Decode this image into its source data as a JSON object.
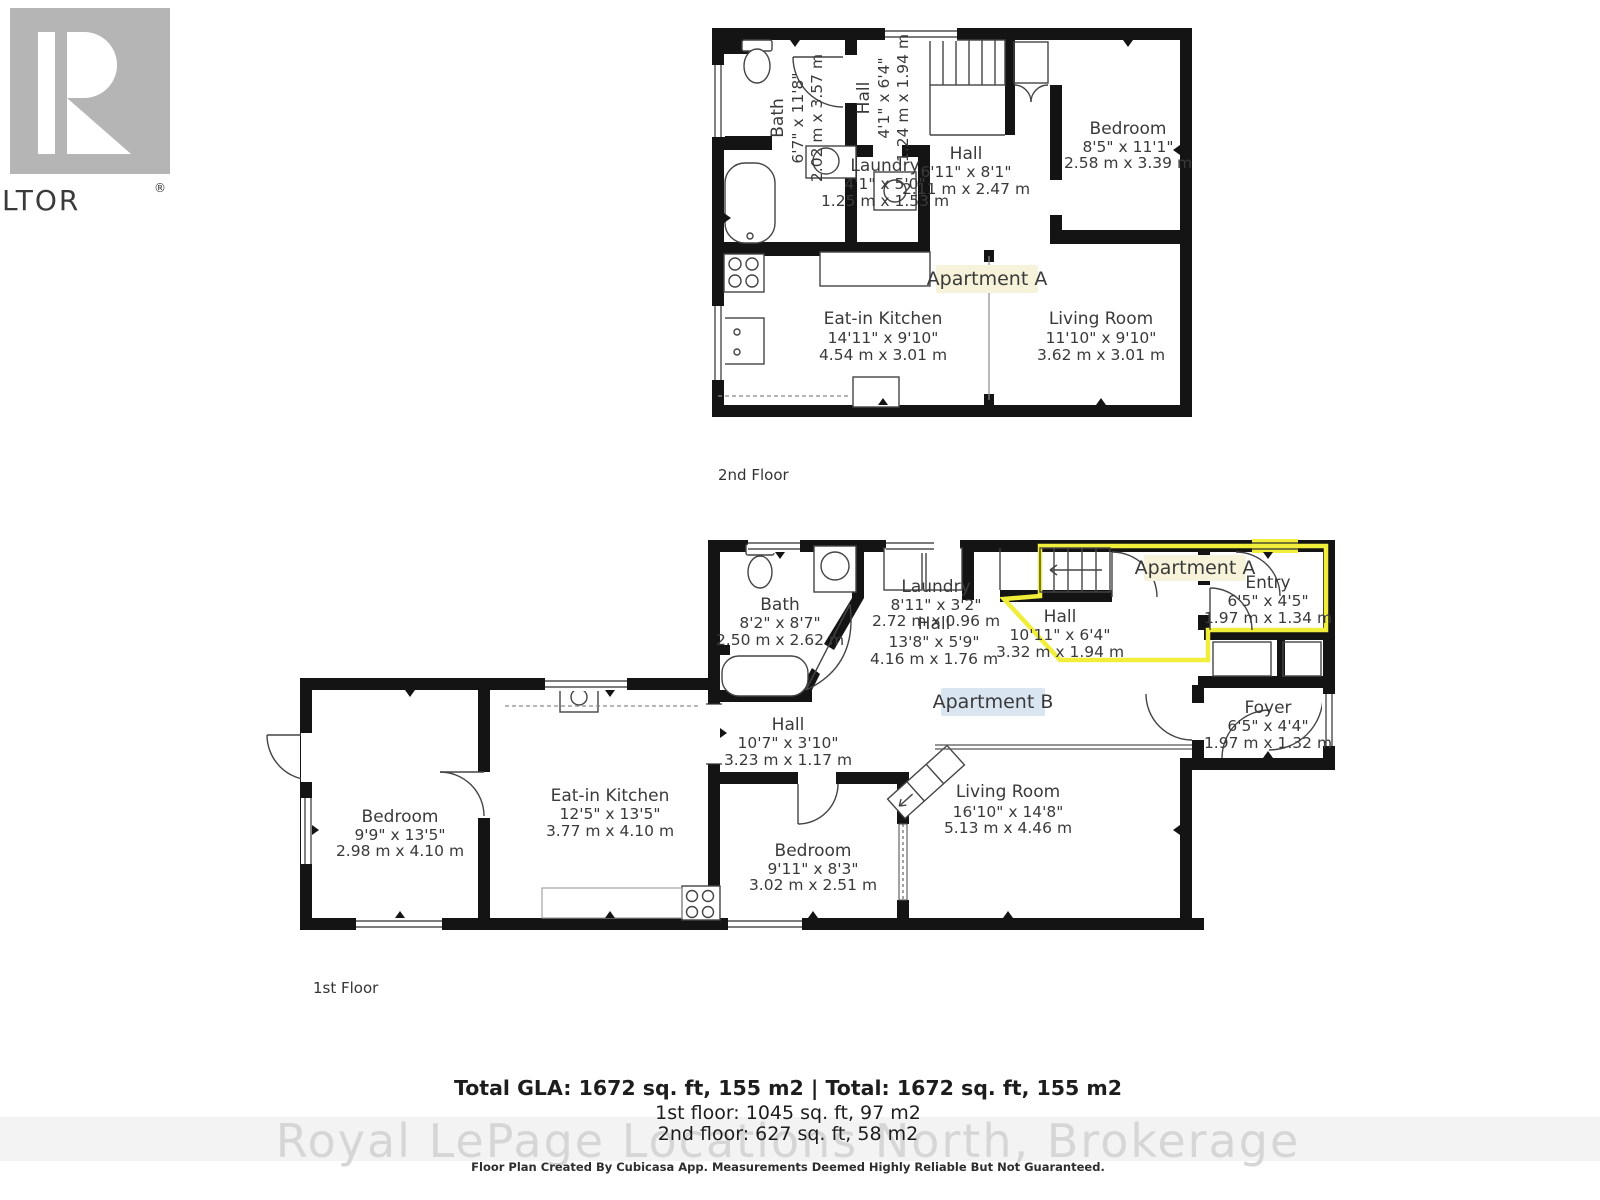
{
  "logo": {
    "letter": "R",
    "label": "REALTOR",
    "registered": "®"
  },
  "floor2": {
    "floor_label": "2nd Floor",
    "apartment_label": "Apartment A",
    "rooms": {
      "bath": {
        "name": "Bath",
        "ft": "6'7\" x 11'8\"",
        "m": "2.02 m x 3.57 m"
      },
      "hall_upper": {
        "name": "Hall",
        "ft": "4'1\" x 6'4\"",
        "m": "1.24 m x 1.94 m"
      },
      "laundry": {
        "name": "Laundry",
        "ft": "4'1\" x 5'0\"",
        "m": "1.25 m x 1.53 m"
      },
      "hall": {
        "name": "Hall",
        "ft": "6'11\" x 8'1\"",
        "m": "2.11 m x 2.47 m"
      },
      "bedroom": {
        "name": "Bedroom",
        "ft": "8'5\" x 11'1\"",
        "m": "2.58 m x 3.39 m"
      },
      "kitchen": {
        "name": "Eat-in Kitchen",
        "ft": "14'11\" x 9'10\"",
        "m": "4.54 m x 3.01 m"
      },
      "living": {
        "name": "Living Room",
        "ft": "11'10\" x 9'10\"",
        "m": "3.62 m x 3.01 m"
      }
    }
  },
  "floor1": {
    "floor_label": "1st Floor",
    "apartment_a_label": "Apartment A",
    "apartment_b_label": "Apartment B",
    "rooms": {
      "bath": {
        "name": "Bath",
        "ft": "8'2\" x 8'7\"",
        "m": "2.50 m x 2.62 m"
      },
      "laundry": {
        "name": "Laundry",
        "ft": "8'11\" x 3'2\"",
        "m": "2.72 m x 0.96 m"
      },
      "hall_back": {
        "name": "Hall",
        "ft": "13'8\" x 5'9\"",
        "m": "4.16 m x 1.76 m"
      },
      "hall_a": {
        "name": "Hall",
        "ft": "10'11\" x 6'4\"",
        "m": "3.32 m x 1.94 m"
      },
      "entry": {
        "name": "Entry",
        "ft": "6'5\" x 4'5\"",
        "m": "1.97 m x 1.34 m"
      },
      "foyer": {
        "name": "Foyer",
        "ft": "6'5\" x 4'4\"",
        "m": "1.97 m x 1.32 m"
      },
      "hall_b": {
        "name": "Hall",
        "ft": "10'7\" x 3'10\"",
        "m": "3.23 m x 1.17 m"
      },
      "bedroom_left": {
        "name": "Bedroom",
        "ft": "9'9\" x 13'5\"",
        "m": "2.98 m x 4.10 m"
      },
      "kitchen": {
        "name": "Eat-in Kitchen",
        "ft": "12'5\" x 13'5\"",
        "m": "3.77 m x 4.10 m"
      },
      "bedroom_mid": {
        "name": "Bedroom",
        "ft": "9'11\" x 8'3\"",
        "m": "3.02 m x 2.51 m"
      },
      "living": {
        "name": "Living Room",
        "ft": "16'10\" x 14'8\"",
        "m": "5.13 m x 4.46 m"
      }
    }
  },
  "footer": {
    "total_line": "Total GLA: 1672 sq. ft, 155 m2 | Total: 1672 sq. ft, 155 m2",
    "first_floor_line": "1st floor: 1045 sq. ft, 97 m2",
    "second_floor_line": "2nd floor: 627 sq. ft, 58 m2",
    "watermark": "Royal LePage Locations North, Brokerage",
    "disclaimer": "Floor Plan Created By Cubicasa App. Measurements Deemed Highly Reliable But Not Guaranteed."
  },
  "colors": {
    "wall": "#141414",
    "apartment_label_text": "#c6392e",
    "apartment_a_bg": "#f7f3da",
    "apartment_b_bg": "#d9e5f1",
    "unit_highlight": "#f1ee3b",
    "logo_gray": "#b5b5b5",
    "room_text": "#3a3a3a",
    "watermark_gray": "#d6d6d6"
  }
}
